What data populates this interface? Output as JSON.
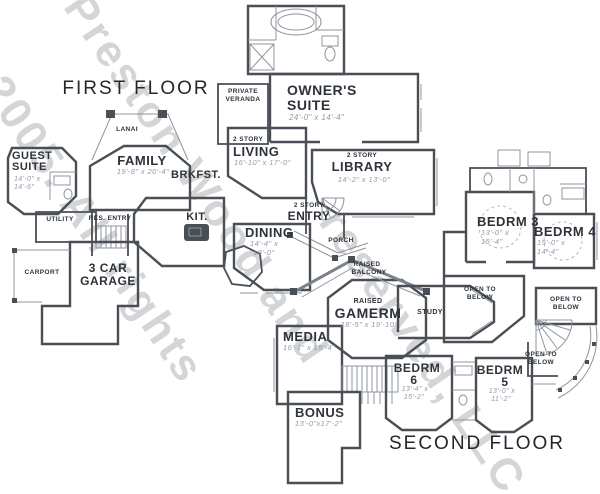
{
  "colors": {
    "wall": "#4a4f56",
    "fixture_line": "#8f959c",
    "label_text": "#2e333a",
    "dimension_text": "#949aa5",
    "watermark": "#9a9ea4"
  },
  "watermark": {
    "line1": "Preston Wood and",
    "line2": "© 2005. All rights",
    "line3": "reserved, LLC"
  },
  "first_floor": {
    "title": "FIRST FLOOR",
    "guest_suite": {
      "line1": "GUEST",
      "line2": "SUITE",
      "dim1": "14'-0\" x",
      "dim2": "14'-6\""
    },
    "family": {
      "name": "FAMILY",
      "dims": "19'-8\" x 20'-4\""
    },
    "lanai": "LANAI",
    "brkfst": "BRKFST.",
    "kitchen": "KIT.",
    "utility": "UTILITY",
    "res_entry": "RES. ENTRY",
    "carport": "CARPORT",
    "garage": {
      "line1": "3 CAR",
      "line2": "GARAGE"
    },
    "owners_suite": {
      "line1": "OWNER'S",
      "line2": "SUITE",
      "dims": "24'-0\" x 14'-4\""
    },
    "private_veranda": {
      "line1": "PRIVATE",
      "line2": "VERANDA"
    },
    "living": {
      "tag": "2 STORY",
      "name": "LIVING",
      "dims": "16'-10\" x 17'-0\""
    },
    "library": {
      "tag": "2 STORY",
      "name": "LIBRARY",
      "dims": "14'-2\" x 13'-0\""
    },
    "entry": {
      "tag": "2 STORY",
      "name": "ENTRY"
    },
    "dining": {
      "name": "DINING",
      "dim1": "14'-4\" x",
      "dim2": "18'-0\""
    },
    "porch": "PORCH"
  },
  "second_floor": {
    "title": "SECOND FLOOR",
    "bedrm3": {
      "name": "BEDRM 3",
      "dim1": "13'-0\" x",
      "dim2": "15'-4\""
    },
    "bedrm4": {
      "name": "BEDRM 4",
      "dim1": "15'-0\" x",
      "dim2": "14'-4\""
    },
    "open_below": {
      "line1": "OPEN TO",
      "line2": "BELOW"
    },
    "raised_balcony": {
      "line1": "RAISED",
      "line2": "BALCONY"
    },
    "gamerm": {
      "tag": "RAISED",
      "name": "GAMERM",
      "dims": "18'-5\" x 19'-10\""
    },
    "study": "STUDY",
    "media": {
      "name": "MEDIA",
      "dims": "16'-1\" x 18'-4\""
    },
    "bedrm6": {
      "line1": "BEDRM",
      "line2": "6",
      "dim1": "13'-4\" x",
      "dim2": "15'-2\""
    },
    "bedrm5": {
      "line1": "BEDRM",
      "line2": "5",
      "dim1": "13'-0\" x",
      "dim2": "11'-2\""
    },
    "bonus": {
      "name": "BONUS",
      "dims": "13'-0\"x17'-2\""
    }
  }
}
